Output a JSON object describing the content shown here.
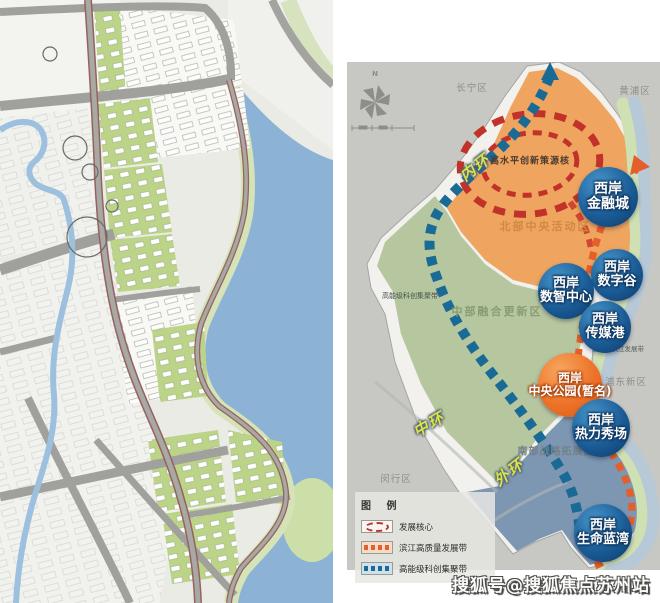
{
  "right_map": {
    "compass_n": "N",
    "districts": {
      "changning": "长宁区",
      "huangpu": "黄浦区",
      "pudong": "浦东新区",
      "minhang": "闵行区"
    },
    "zones": {
      "north": "北部中央活动区",
      "central": "中部融合更新区",
      "south": "南部战略拓展区",
      "innovation_core": "高水平创新策源核",
      "science_belt": "高能级科创集聚带",
      "riverside_belt": "高质量滨江发展带"
    },
    "rings": {
      "inner": "内环",
      "middle": "中环",
      "outer": "外环"
    },
    "nodes": [
      {
        "id": "financial-city",
        "line1": "西岸",
        "line2": "金融城",
        "color": "blue"
      },
      {
        "id": "digital-valley",
        "line1": "西岸",
        "line2": "数字谷",
        "color": "blue"
      },
      {
        "id": "smart-center",
        "line1": "西岸",
        "line2": "数智中心",
        "color": "blue"
      },
      {
        "id": "media-port",
        "line1": "西岸",
        "line2": "传媒港",
        "color": "blue"
      },
      {
        "id": "central-park",
        "line1": "西岸",
        "line2": "中央公园(暂名)",
        "color": "orange"
      },
      {
        "id": "dynamic-show",
        "line1": "西岸",
        "line2": "热力秀场",
        "color": "blue"
      },
      {
        "id": "life-blue-bay",
        "line1": "西岸",
        "line2": "生命蓝湾",
        "color": "blue"
      }
    ],
    "legend": {
      "title": "图 例",
      "items": [
        {
          "label": "发展核心",
          "symbol": "red-dashed-ellipse"
        },
        {
          "label": "滨江高质量发展带",
          "symbol": "orange-dashed-line"
        },
        {
          "label": "高能级科创集聚带",
          "symbol": "blue-dashed-line"
        }
      ]
    },
    "colors": {
      "background": "#c7c7c3",
      "north_zone": "#efa55f",
      "central_zone": "#b6c7a0",
      "south_zone": "#7d97b2",
      "river": "#b7c9d6",
      "science_belt": "#1a6a96",
      "riverside_belt": "#e55f2b",
      "core_ring": "#c1332a",
      "node_blue": "#0b3a6b",
      "node_orange": "#ed7228",
      "ring_label": "#d8e44c"
    }
  },
  "watermark": "搜狐号@搜狐焦点苏州站"
}
